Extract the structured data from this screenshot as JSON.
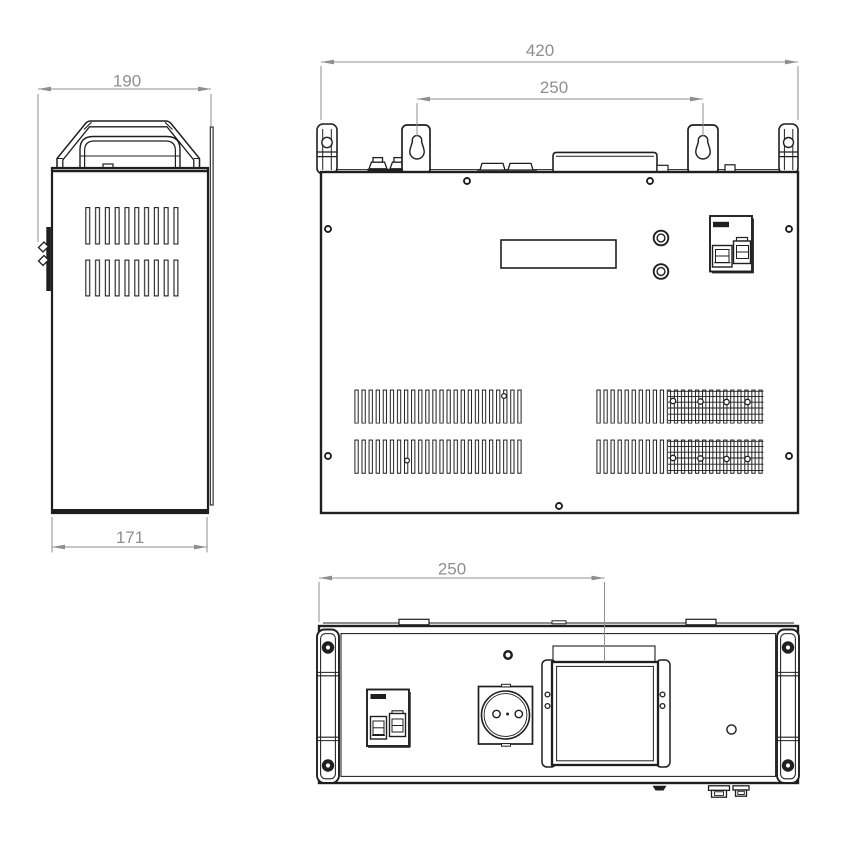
{
  "palette": {
    "background": "#ffffff",
    "line": "#1f1f1f",
    "dimension": "#8f8f8f"
  },
  "views": {
    "side": {
      "name": "side-view",
      "width_label": "190",
      "base_width_label": "171"
    },
    "front": {
      "name": "front-view",
      "overall_width_label": "420",
      "mount_spacing_label": "250"
    },
    "bottom": {
      "name": "bottom-view",
      "terminal_offset_label": "250"
    }
  }
}
